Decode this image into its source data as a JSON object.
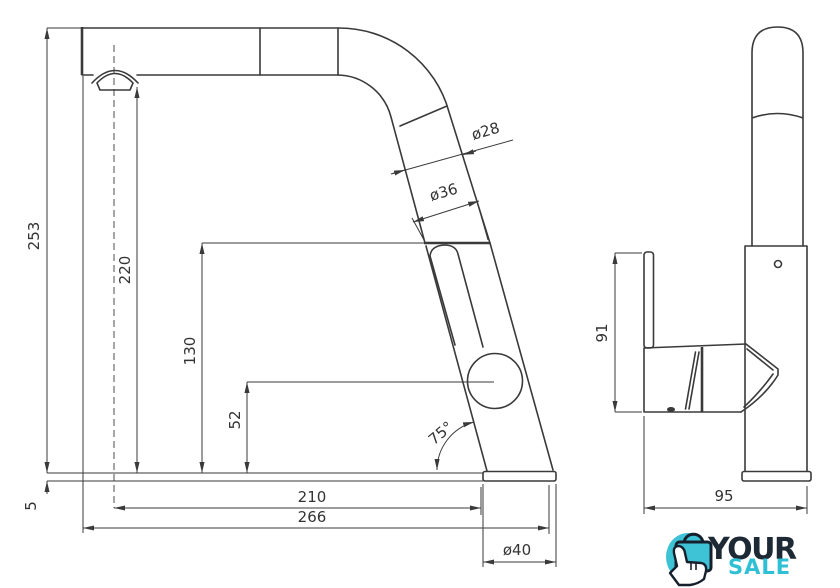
{
  "dimensions": {
    "front": {
      "total_height": "253",
      "spout_height": "220",
      "head_joint_height": "130",
      "head_center_height": "52",
      "base_plate_thickness": "5",
      "spout_diameter": "ø28",
      "head_diameter": "ø36",
      "spout_reach": "210",
      "total_reach": "266",
      "base_diameter": "ø40",
      "spout_angle": "75°"
    },
    "side": {
      "handle_height": "91",
      "body_depth": "95"
    }
  },
  "logo": {
    "line1": "YOUR",
    "line2": "SALE",
    "colors": {
      "navy": "#1d2935",
      "teal": "#2fc0d5",
      "icon_teal": "#3dc2d6"
    }
  }
}
